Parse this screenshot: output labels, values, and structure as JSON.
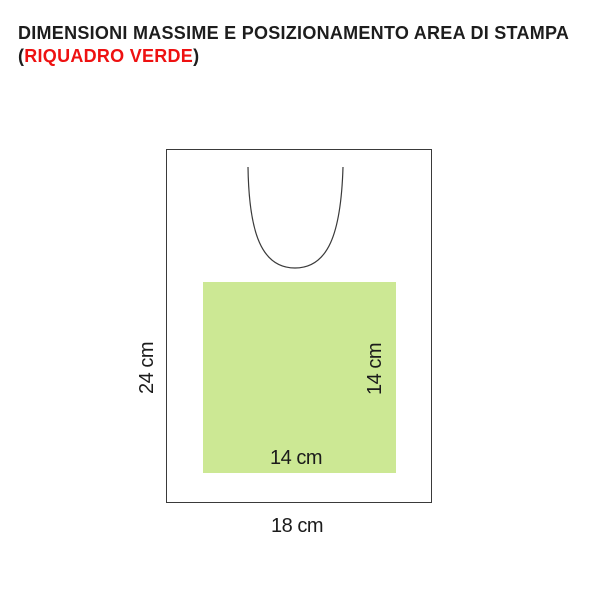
{
  "title": {
    "line1": "DIMENSIONI MASSIME E POSIZIONAMENTO AREA DI STAMPA",
    "line2": {
      "prefix": "(",
      "highlight": "RIQUADRO VERDE",
      "suffix": ")"
    }
  },
  "diagram": {
    "labels": {
      "bag_height": "24 cm",
      "bag_width": "18 cm",
      "print_area_height": "14 cm",
      "print_area_width": "14 cm"
    },
    "colors": {
      "print_area_fill": "#cce894",
      "outline_stroke": "#3a3a3a",
      "title_text": "#1d1d1d",
      "highlight_red": "#ee1111",
      "label_text": "#1b1b1b"
    }
  }
}
